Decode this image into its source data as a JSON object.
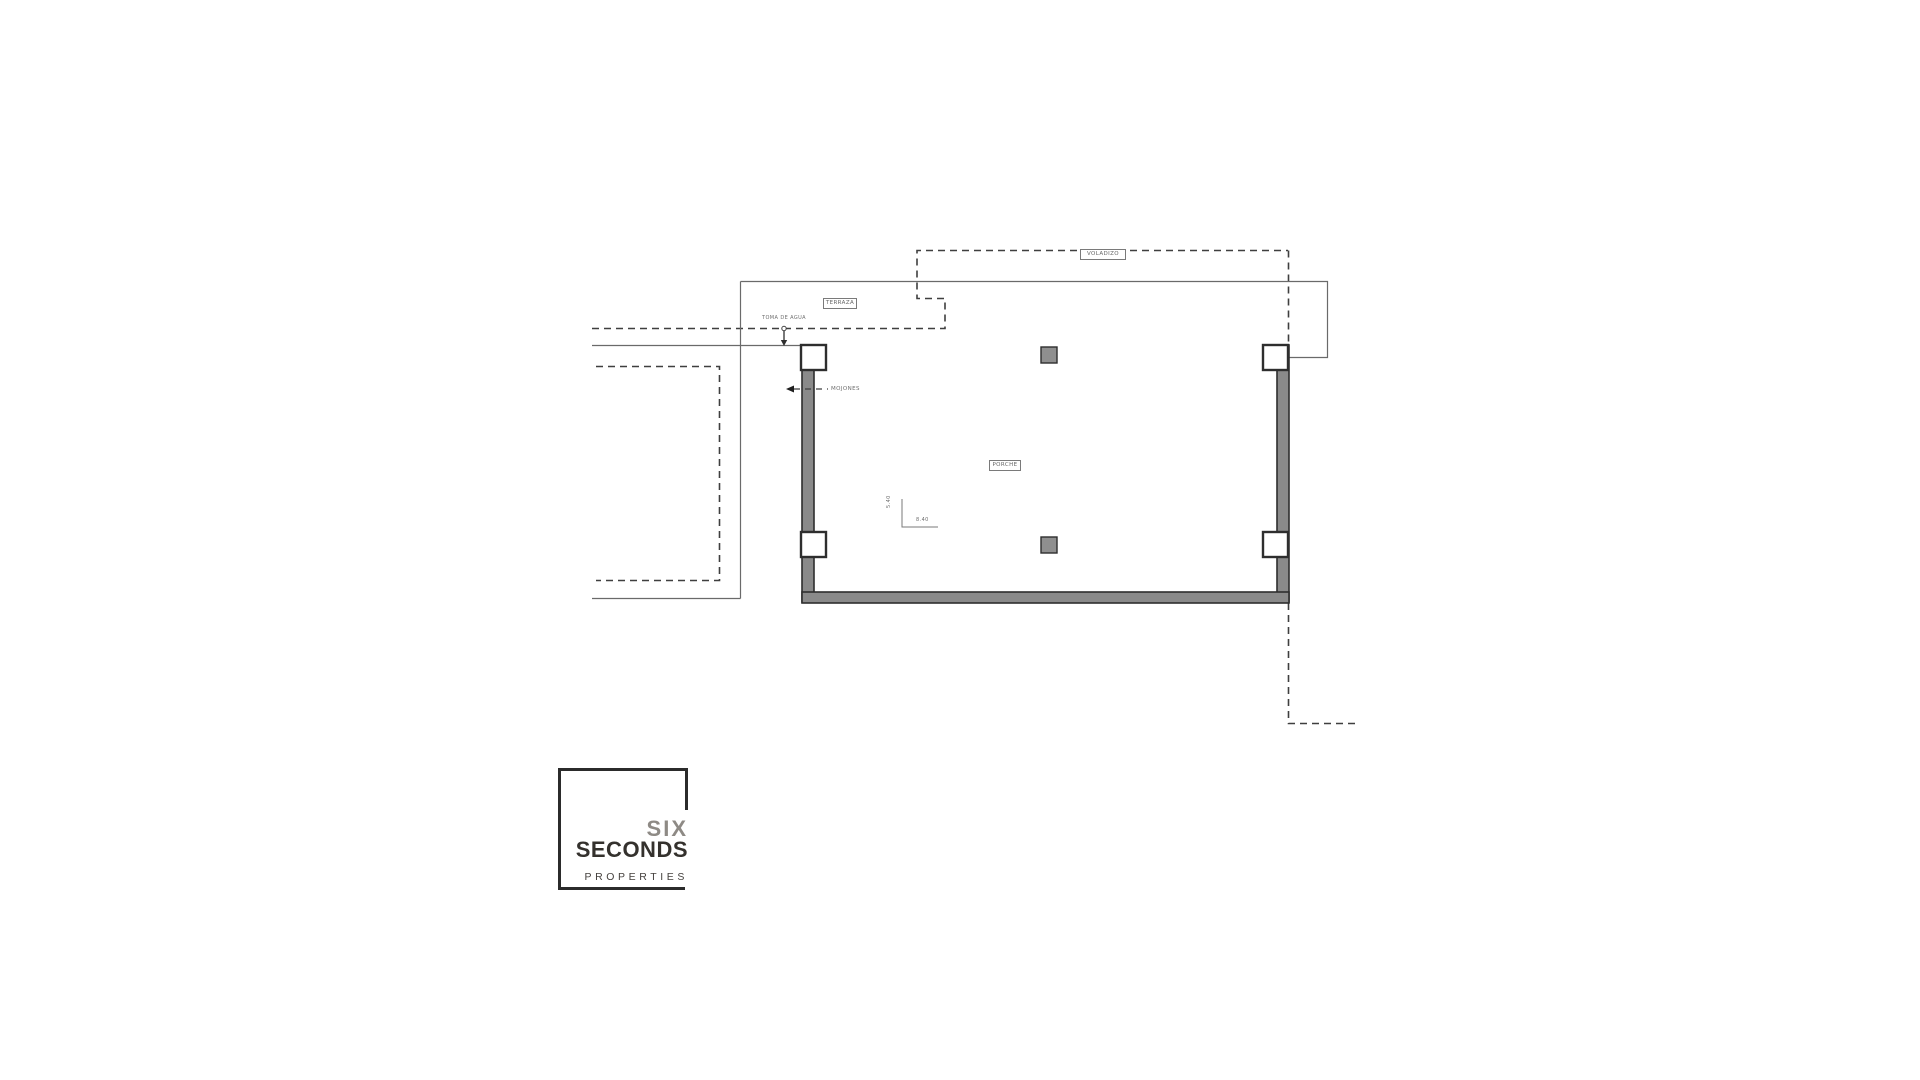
{
  "plan": {
    "labels": {
      "voladizo": "VOLADIZO",
      "terraza": "TERRAZA",
      "porche": "PORCHE",
      "toma_de_agua": "TOMA DE AGUA",
      "mojones": "MOJONES",
      "dim_vertical": "5.40",
      "dim_horizontal": "8.40"
    },
    "colors": {
      "wall_fill": "#8a8a8a",
      "wall_stroke": "#2e2e2e",
      "column_fill": "#8f8f8f",
      "thin_line": "#6a6a6a",
      "dashed_line": "#3f3f3f",
      "label_text": "#666666"
    }
  },
  "logo": {
    "line1": "SIX",
    "line2": "SECONDS",
    "line3": "PROPERTIES",
    "colors": {
      "line1": "#8e8a85",
      "line2": "#34312d",
      "line3": "#45413e",
      "border": "#2b2b2b"
    }
  }
}
